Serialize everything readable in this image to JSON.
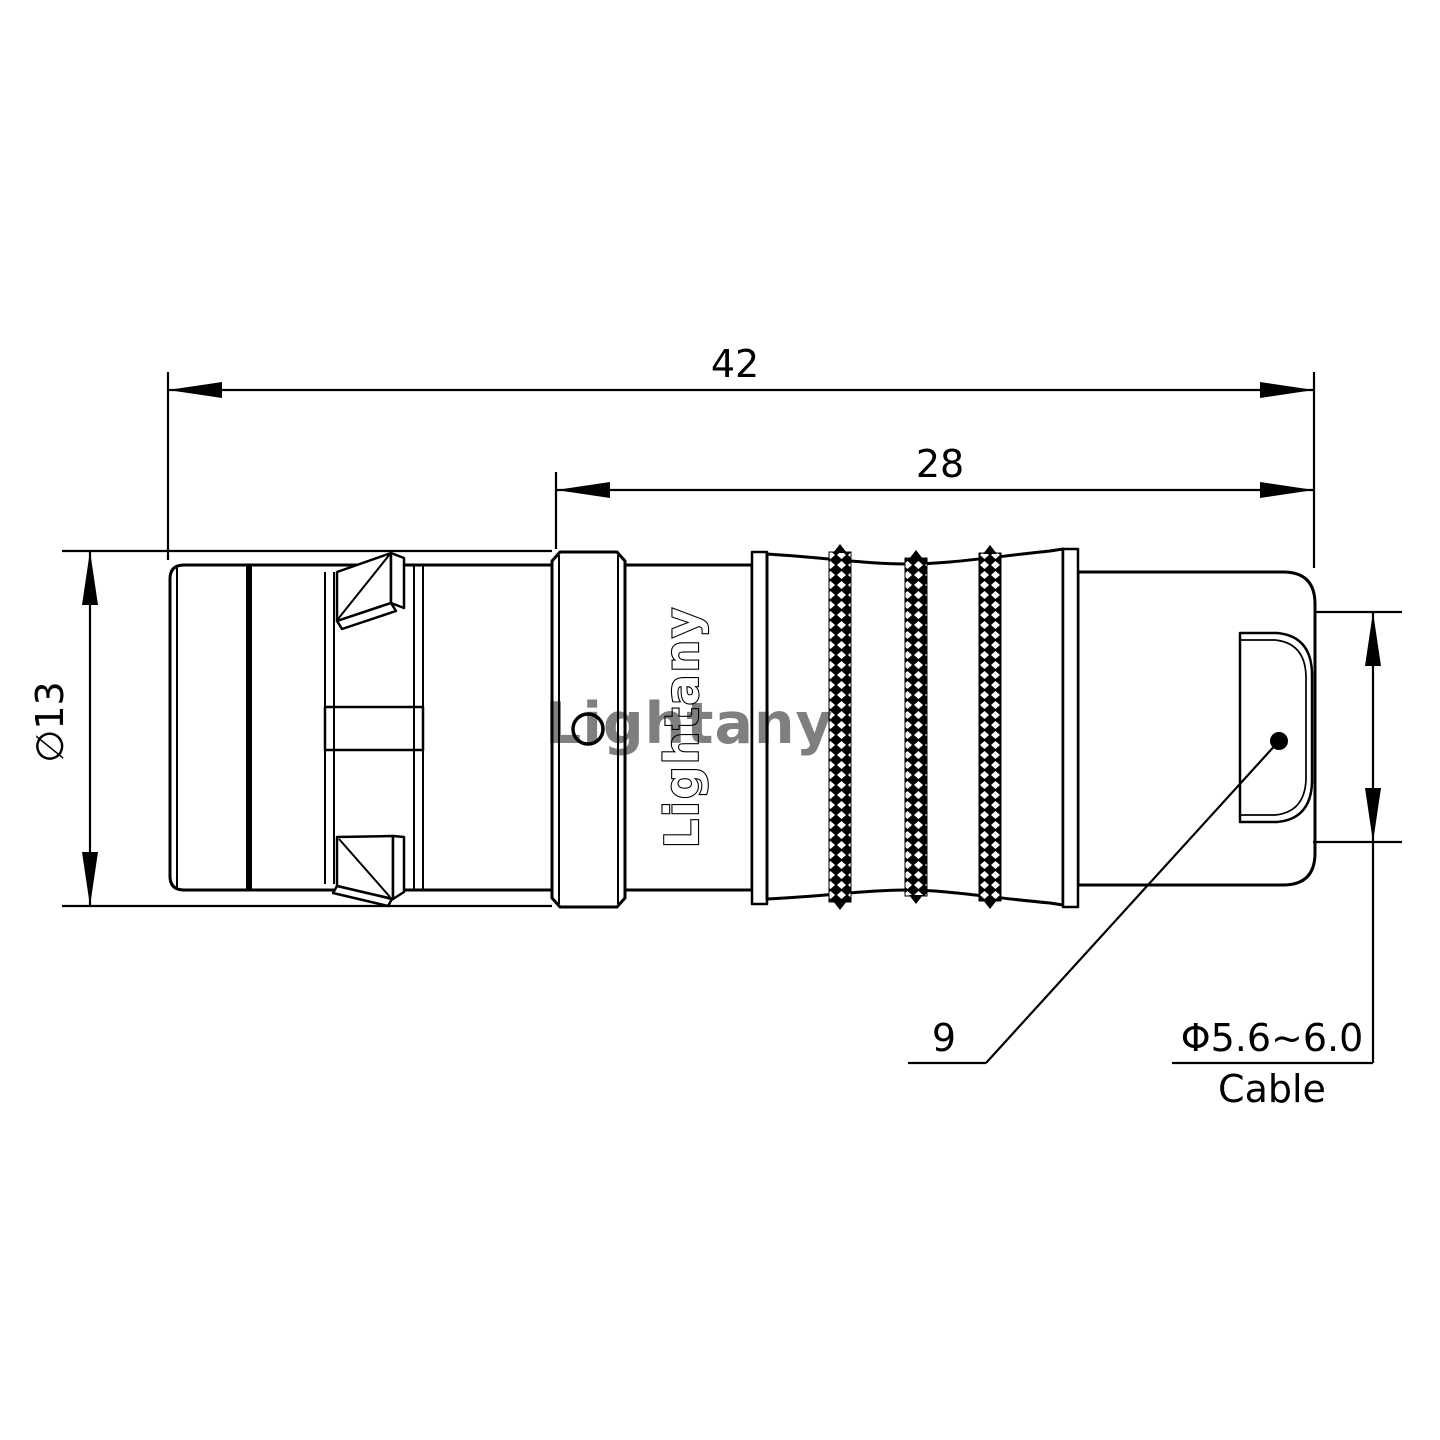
{
  "drawing": {
    "watermark_text": "Lightany",
    "brand_label_vertical": "Lightany",
    "dim_overall_length": "42",
    "dim_rear_section_length": "28",
    "dim_shell_diameter": "∅13",
    "callout_item": "9",
    "cable_diameter": "Φ5.6~6.0",
    "cable_caption": "Cable",
    "colors": {
      "line": "#000000",
      "body_fill": "#ffffff",
      "watermark_pink": "#e08f8f",
      "background": "#ffffff"
    }
  }
}
